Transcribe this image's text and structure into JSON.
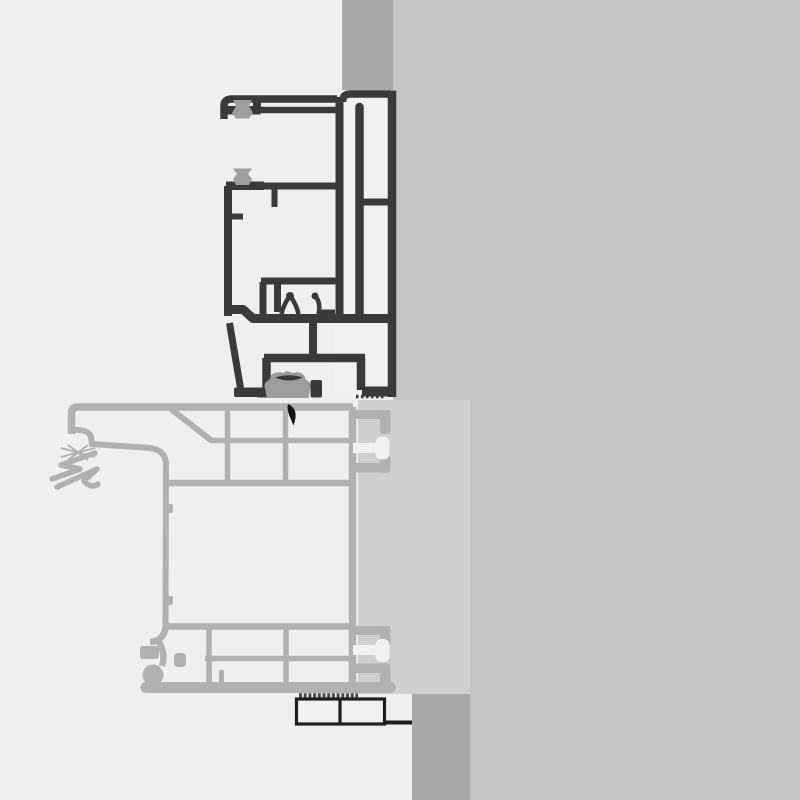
{
  "diagram": {
    "type": "technical-cross-section",
    "subject": "window-door-frame-profile-junction-detail",
    "orientation": "vertical-section",
    "text_labels": [],
    "parts": {
      "upper_profile": "sash-and-frame-extrusion-dark",
      "lower_profile": "sill-threshold-extrusion-light",
      "seals": [
        "brush-seal-upper",
        "brush-seal-lower",
        "compression-gasket"
      ],
      "membrane": "black-teardrop-seal",
      "masonry": [
        "wall-band-top",
        "wall-band-bottom"
      ],
      "panel": "backing-panel",
      "bottom_component": "spacer-block-two-cell"
    }
  },
  "colors": {
    "bg-left": "#efefef",
    "bg-right": "#c5c5c5",
    "wall-band": "#a9a9a9",
    "panel": "#cfcfcf",
    "profile-dark": "#3a3a3a",
    "profile-light": "#b1b1b1",
    "seal": "#9e9e9e",
    "cell-white": "#f1f1f1",
    "box-stroke": "#1e1e1e",
    "membrane-black": "#151515",
    "hatch": "#4a4a4a"
  }
}
